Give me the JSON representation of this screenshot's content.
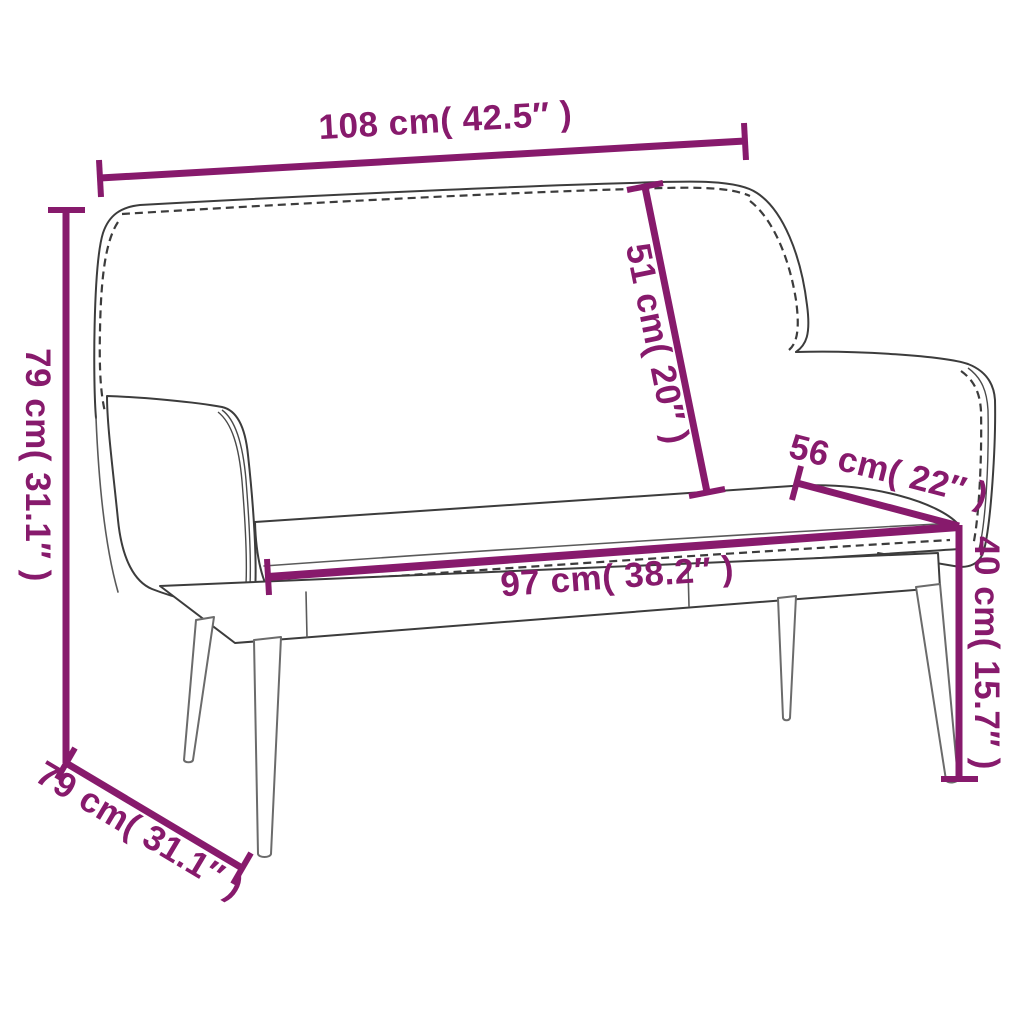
{
  "image": {
    "product": "bench with backrest line drawing",
    "background": "#ffffff",
    "accent_color": "#871a6c",
    "sketch_color": "#3c3c3c",
    "dimensions": {
      "overall_width": {
        "label": "108 cm( 42.5″ )",
        "cm": 108,
        "inches": 42.5
      },
      "overall_height": {
        "label": "79 cm( 31.1″ )",
        "cm": 79,
        "inches": 31.1
      },
      "backrest_height": {
        "label": "51 cm( 20″ )",
        "cm": 51,
        "inches": 20
      },
      "seat_depth": {
        "label": "56 cm( 22″ )",
        "cm": 56,
        "inches": 22
      },
      "seat_width": {
        "label": "97 cm( 38.2″ )",
        "cm": 97,
        "inches": 38.2
      },
      "seat_height": {
        "label": "40 cm( 15.7″ )",
        "cm": 40,
        "inches": 15.7
      },
      "overall_depth": {
        "label": "79 cm( 31.1″ )",
        "cm": 79,
        "inches": 31.1
      }
    }
  }
}
